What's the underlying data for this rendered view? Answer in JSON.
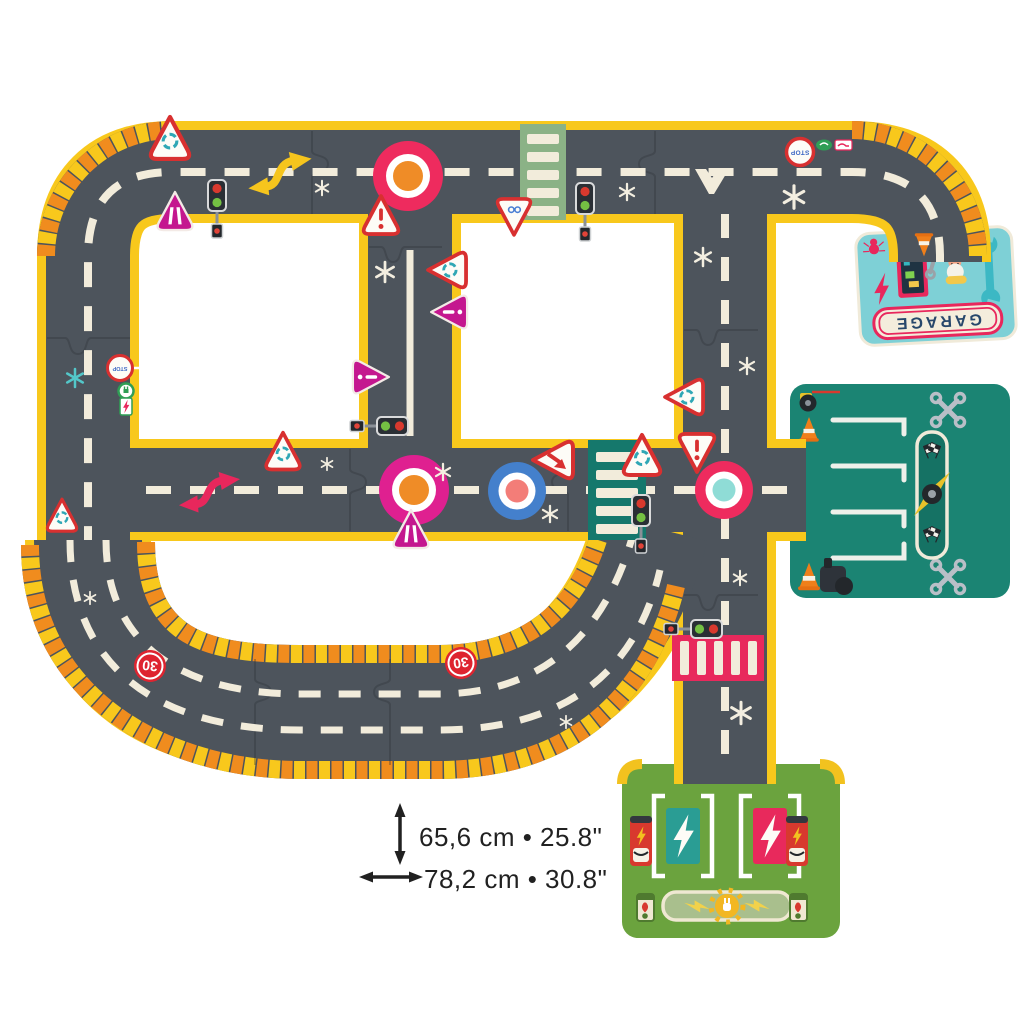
{
  "scene": "Giant road circuit puzzle for children with garage, parking and charging station pieces",
  "labels": {
    "garage": "GARAGE",
    "stop": "STOP",
    "stop_small": "STOP",
    "speed_limit_a": "30",
    "speed_limit_b": "30"
  },
  "annotations": {
    "height_label": "65,6 cm • 25.8\"",
    "width_label": "78,2 cm • 30.8\""
  },
  "colors": {
    "road": "#4d545c",
    "road_edge_yellow": "#f8c81c",
    "hazard_orange": "#f08c1e",
    "marking_cream": "#f2ecdb",
    "crosswalk_green": "#8bb286",
    "crosswalk_teal": "#15786c",
    "crosswalk_pink": "#e8295c",
    "sign_red": "#d83030",
    "sign_magenta": "#c4178f",
    "roundabout_pink": "#ee2b5e",
    "roundabout_magenta": "#df2090",
    "roundabout_blue": "#4480cc",
    "roundabout_center_orange": "#ef8c27",
    "roundabout_center_teal": "#8fdcd6",
    "garage_bg": "#7ed0d6",
    "garage_accent": "#e8275c",
    "parking_bg": "#1b8473",
    "station_bg": "#6ba33e",
    "annotation_text": "#212121"
  },
  "icons": {
    "wrench": "garage tool",
    "crossed-wrenches": "service area marker",
    "checkered-flag": "race finish flags",
    "lightning-bolt": "electric charging",
    "tire": "pit stop tire",
    "traffic-cone": "work zone cone",
    "traffic-light": "signal",
    "roundabout-warning": "triangular road sign",
    "sparkle": "decorative star"
  }
}
